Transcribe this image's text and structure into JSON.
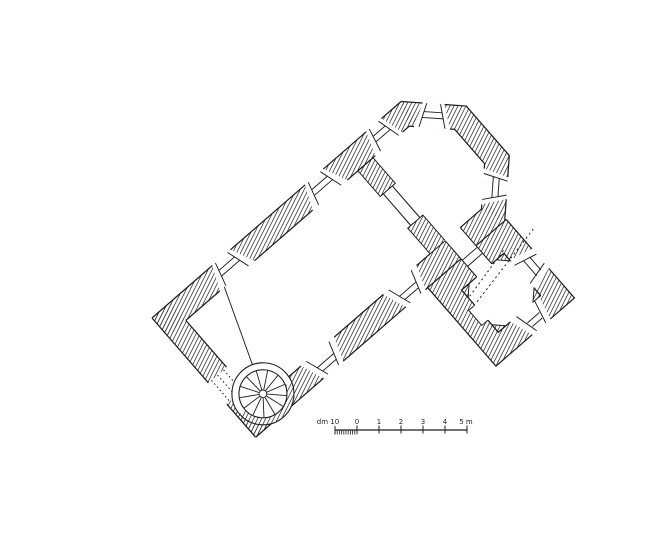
{
  "document": {
    "type": "architectural floor plan",
    "style": "black-ink survey drawing (scanned), church ground plan rotated diagonally"
  },
  "colors": {
    "ink": "#1f1f1f",
    "paper": "#ffffff",
    "hatch": "#333333"
  },
  "plan": {
    "rotation_deg": -41,
    "features": [
      "nave",
      "chancel-arch",
      "polygonal-apse",
      "sacristy",
      "spiral-staircase",
      "west-gallery-line",
      "splayed-windows",
      "west-portal"
    ]
  },
  "scale_bar": {
    "y": 430,
    "x_start": 335,
    "x_end": 467,
    "meters_per_division": 1,
    "px_per_meter": 22,
    "labels": [
      {
        "text": "dm 10",
        "x": 328
      },
      {
        "text": "0",
        "x": 357
      },
      {
        "text": "1",
        "x": 379
      },
      {
        "text": "2",
        "x": 401
      },
      {
        "text": "3",
        "x": 423
      },
      {
        "text": "4",
        "x": 445
      },
      {
        "text": "5 m",
        "x": 466
      }
    ],
    "major_ticks_x": [
      357,
      379,
      401,
      423,
      445,
      467
    ],
    "dm_ticks": {
      "start_x": 335,
      "step": 2.2,
      "count": 11
    }
  }
}
